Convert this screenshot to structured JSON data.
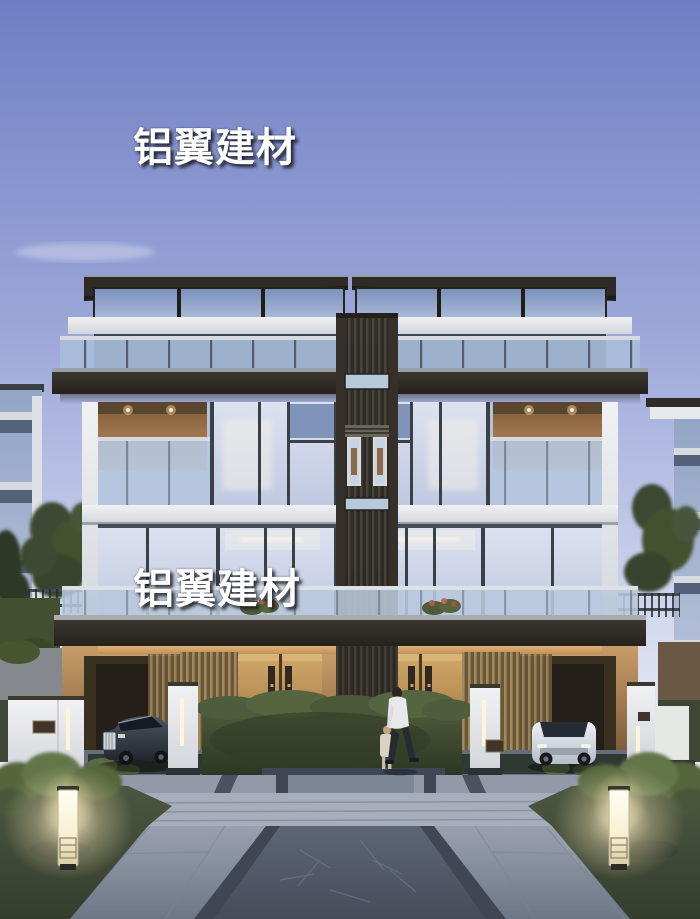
{
  "image": {
    "type": "architectural-rendering",
    "subject": "Modern twin villa exterior at dusk with glass facades, lit carports, two parked cars, pedestrians and a landscaped stone plaza",
    "watermarks": [
      {
        "text": "铝翼建材",
        "position": "upper-left-of-center"
      },
      {
        "text": "铝翼建材",
        "position": "middle-left-of-center"
      }
    ],
    "palette": {
      "sky_top": "#6e7ec2",
      "sky_horizon": "#f0f1f7",
      "roof_dark": "#2e2a24",
      "glass_blue": "#a9bcd9",
      "white_slab": "#eceef0",
      "warm_glow": "#d9ae79",
      "wood_door": "#b68a4e",
      "pavement": "#8a93a3",
      "path_dark": "#57606f",
      "hedge_green": "#45523a",
      "lamp_glow": "#fff7d8"
    }
  }
}
